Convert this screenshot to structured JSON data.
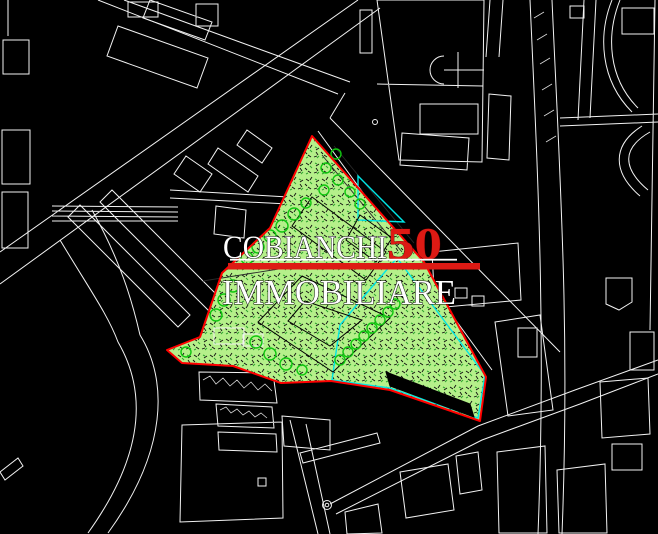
{
  "window": {
    "width_px": 658,
    "height_px": 534,
    "kind": "CAD site plan screenshot"
  },
  "logo": {
    "line1": "COBIANCHI",
    "number": "50",
    "line2": "IMMOBILIARE"
  },
  "colors": {
    "bg": "#000000",
    "linework": "#f2f2f2",
    "boundary_red": "#ff0000",
    "logo_red": "#dd1a14",
    "logo_white": "#ffffff",
    "veg_fill": "#b5f08a",
    "veg_mark_dark": "#0d0d0d",
    "veg_mark_green": "#2fa32f",
    "tree_stroke": "#0fc60f",
    "red_building_fill": "#ee1a12",
    "red_building_dot": "#ffffff",
    "paved_fill": "#e3fbf6",
    "paved_mark": "#101010",
    "paved_edge": "#00e6e6",
    "solid_building": "#000000"
  },
  "regions": {
    "site_boundary": "red outline polygon",
    "vegetation": "green stippled area with trees",
    "planned_buildings": "red dot-hatched bands",
    "paved_area": "pale cyan cross-hatched area",
    "existing_building": "solid black bar"
  }
}
